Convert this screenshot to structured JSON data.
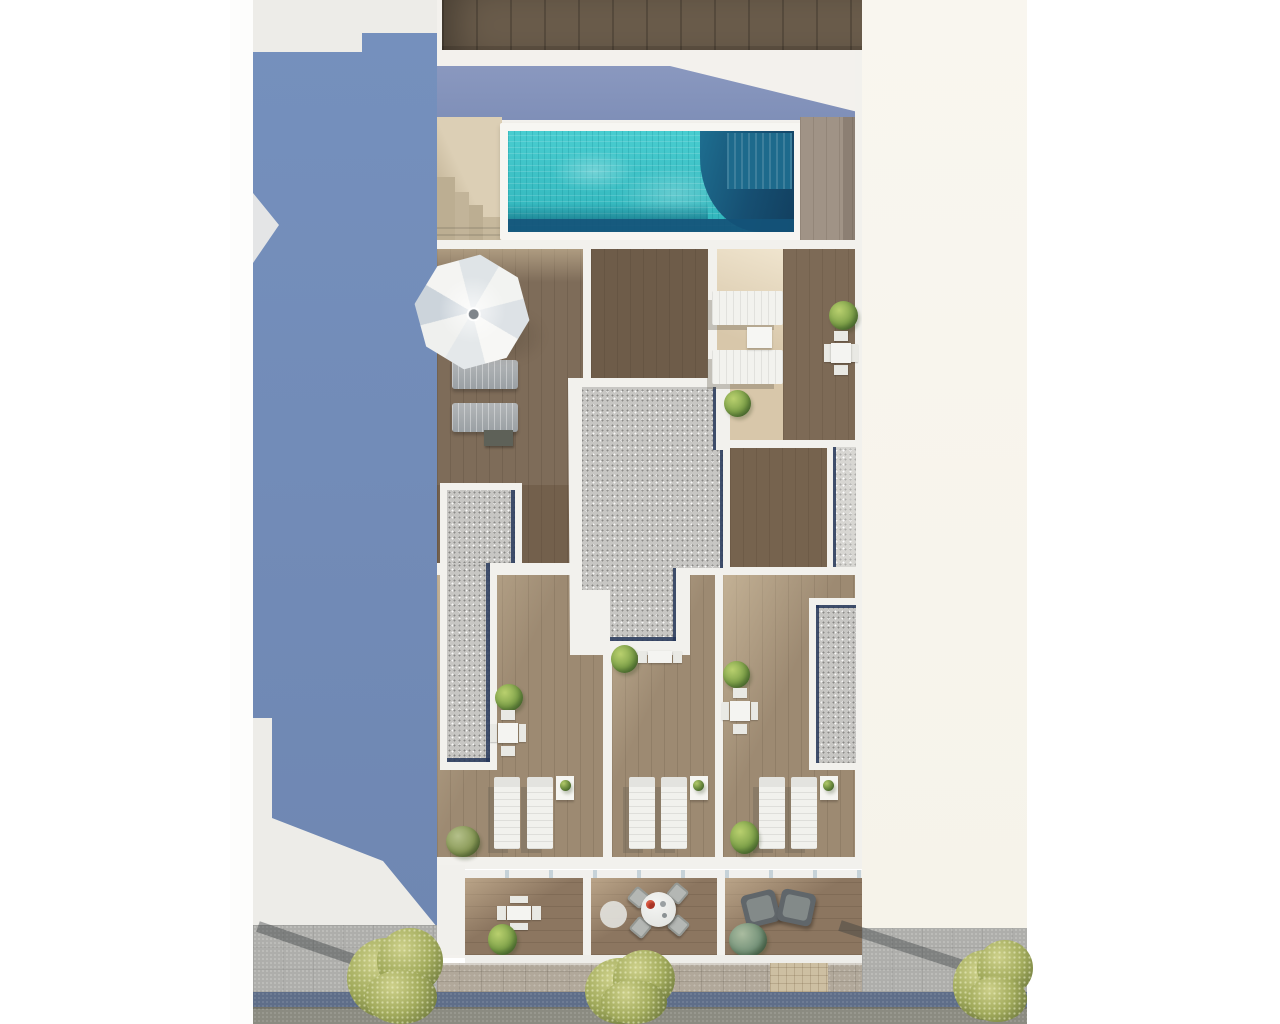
{
  "scene": {
    "title": "aerial-architectural-render-rooftop-pool",
    "setting": "top-down 3D render of a residential building roof terrace with pool, terraces, balconies and street",
    "no_visible_text": true,
    "palette": {
      "page_background": "#ffffff",
      "shadow_blue": "#7289b5",
      "shadow_blue_light": "#8593ba",
      "building_white": "#f3f1ed",
      "warm_white_right_block": "#f8f5ee",
      "top_strip_wood_dark": "#6a5c4b",
      "deck_wood_mid": "#7e6c59",
      "deck_wood_dark": "#6e5c49",
      "terrace_wood": "#9d8a72",
      "balcony_wood": "#8c7660",
      "beige_deck": "#d8c7aa",
      "stairs_beige": "#dccfb5",
      "pool_turquoise": "#3fc3c6",
      "pool_navy": "#15506f",
      "gravel_gray": "#c7c6c3",
      "pavement_gray": "#aeaeab",
      "stone_band": "#b1a89a",
      "curb_blue_gray": "#5f6e89",
      "road_gray": "#8b8b81",
      "tree_olive": "#a2ab5c",
      "lounger_white": "#f1f1ed",
      "lounger_gray": "#a9adb0",
      "armchair_gray": "#60666a",
      "accent_red_bowl": "#a83426"
    },
    "objects": {
      "swimming_pool": 1,
      "pool_steps": 1,
      "staircase": 1,
      "parasol": 1,
      "sun_loungers_gray": 2,
      "sun_loungers_white": 8,
      "side_tables": 5,
      "dining_table_sets": 5,
      "round_dining_table": 1,
      "wicker_chairs": 4,
      "armchairs": 2,
      "round_rug": 1,
      "potted_plants": 9,
      "small_pot_plants": 3,
      "street_trees": 3,
      "gravel_roof_sections": 4,
      "balconies": 3,
      "terraces": 6
    }
  }
}
